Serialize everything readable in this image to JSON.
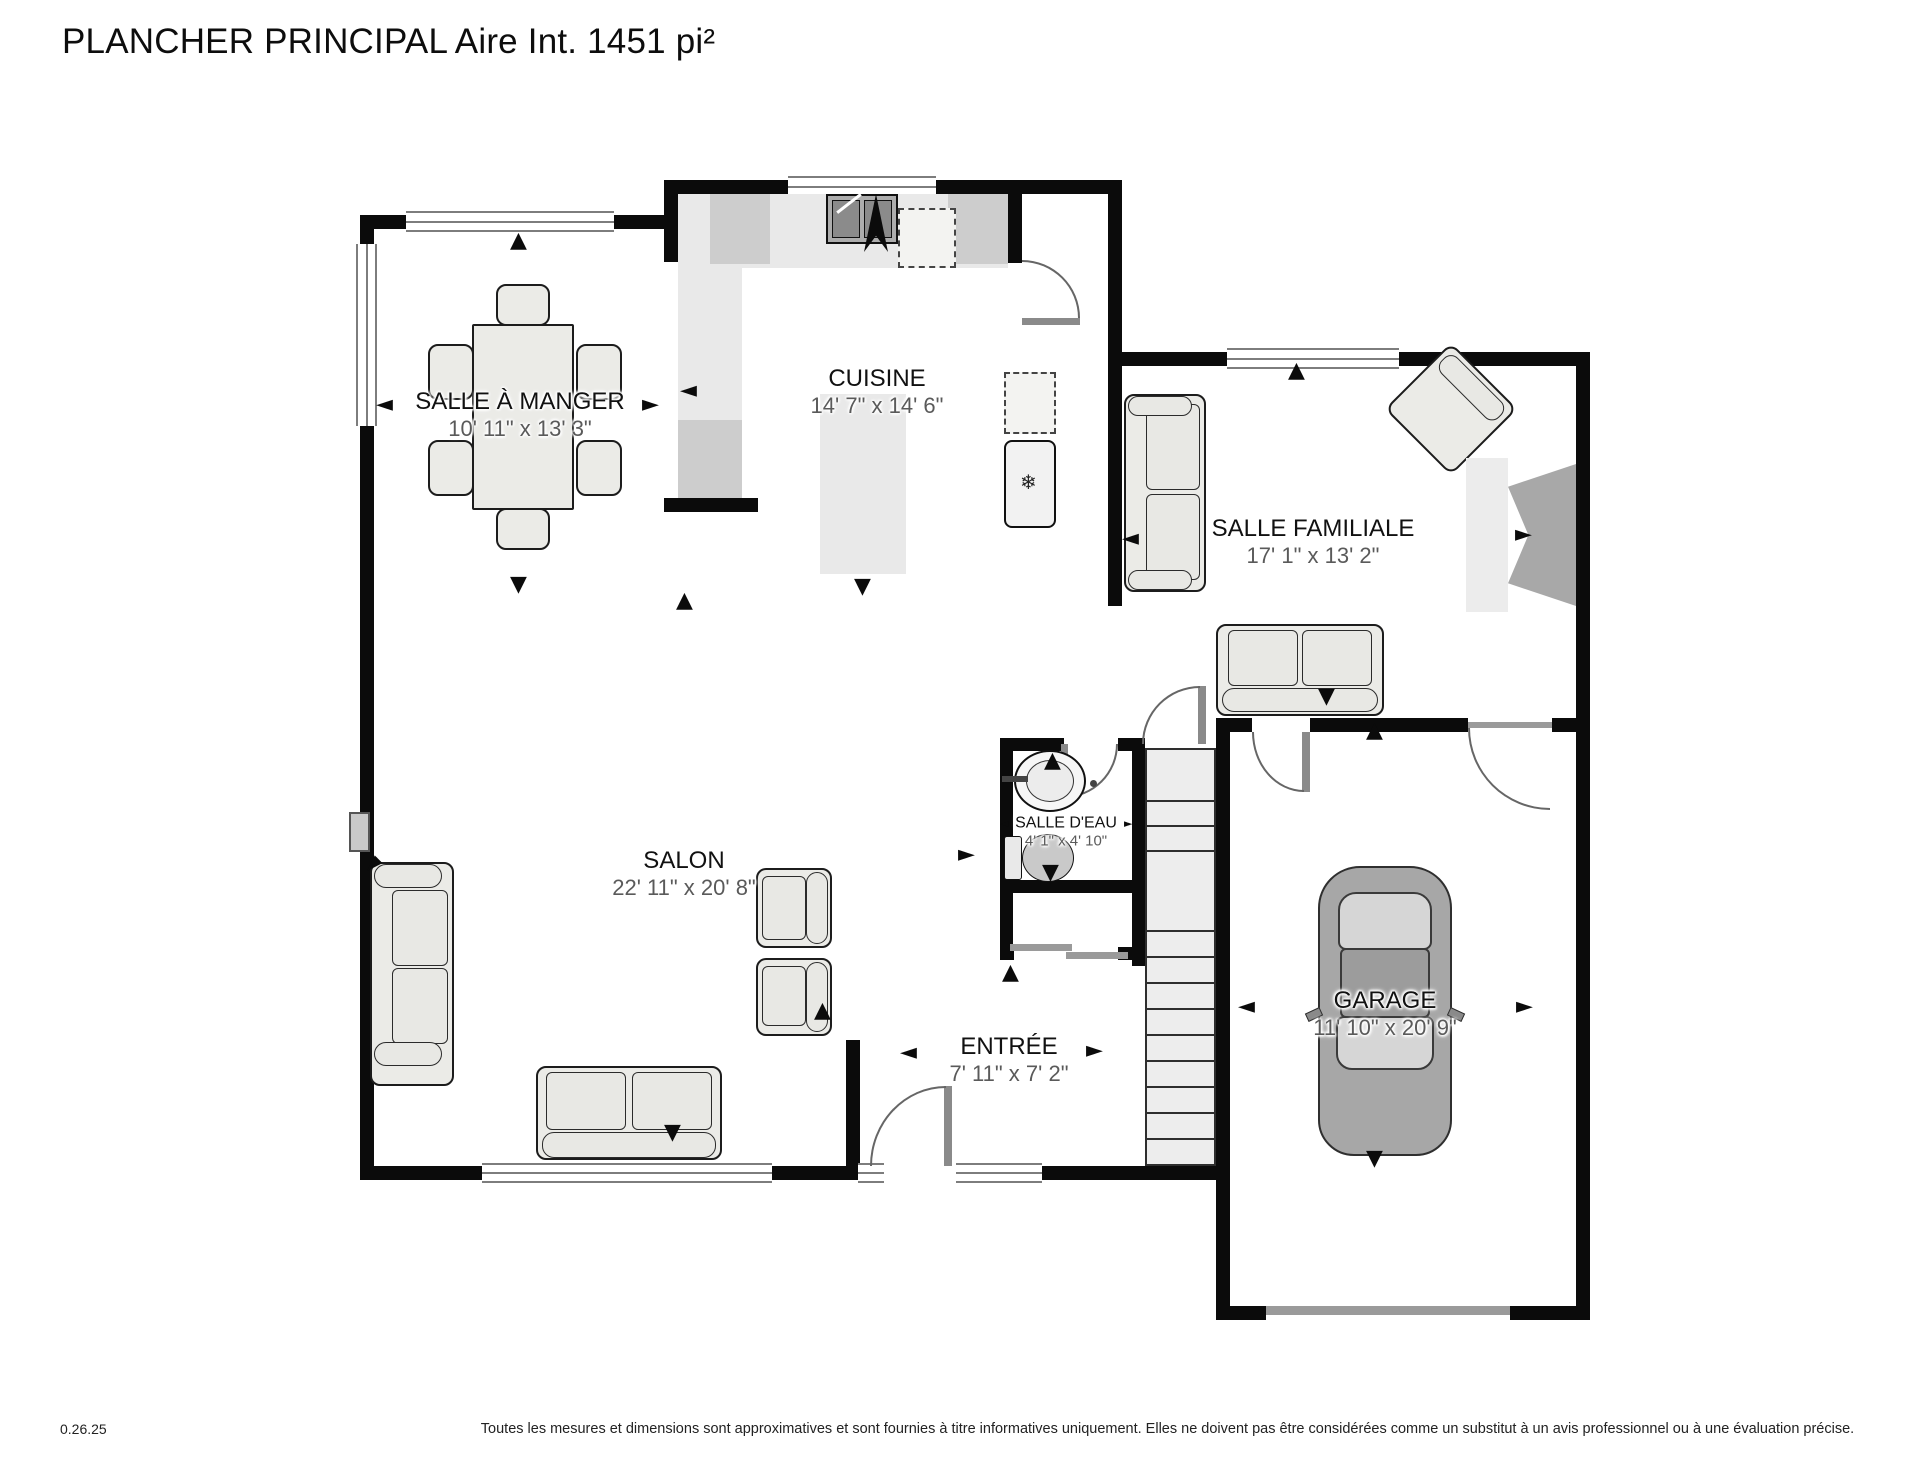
{
  "title": "PLANCHER PRINCIPAL Aire Int. 1451 pi²",
  "rooms": [
    {
      "name": "SALLE À MANGER",
      "dims": "10' 11\" x 13' 3\""
    },
    {
      "name": "CUISINE",
      "dims": "14' 7\" x 14' 6\""
    },
    {
      "name": "SALLE FAMILIALE",
      "dims": "17' 1\" x 13' 2\""
    },
    {
      "name": "SALON",
      "dims": "22' 11\" x 20' 8\""
    },
    {
      "name": "SALLE D'EAU",
      "dims": "4' 1\" x 4' 10\""
    },
    {
      "name": "ENTRÉE",
      "dims": "7' 11\" x 7' 2\""
    },
    {
      "name": "GARAGE",
      "dims": "11' 10\" x 20' 9\""
    }
  ],
  "icons": {
    "arrow_up": "▲",
    "arrow_down": "▼",
    "arrow_left": "◄",
    "arrow_right": "►",
    "snowflake": "❄"
  },
  "colors": {
    "wall": "#0b0b0b",
    "furniture_fill": "#ebebe7",
    "counter": "#e9e9e9",
    "appliance_dark": "#cdcdcd",
    "car_body": "#a7a7a7",
    "dims_text": "#5a5a5a"
  },
  "footer": {
    "version": "0.26.25",
    "disclaimer": "Toutes les mesures et dimensions sont approximatives et sont fournies à titre informatives uniquement. Elles ne doivent pas être considérées comme un substitut à un avis professionnel ou à une évaluation précise."
  }
}
